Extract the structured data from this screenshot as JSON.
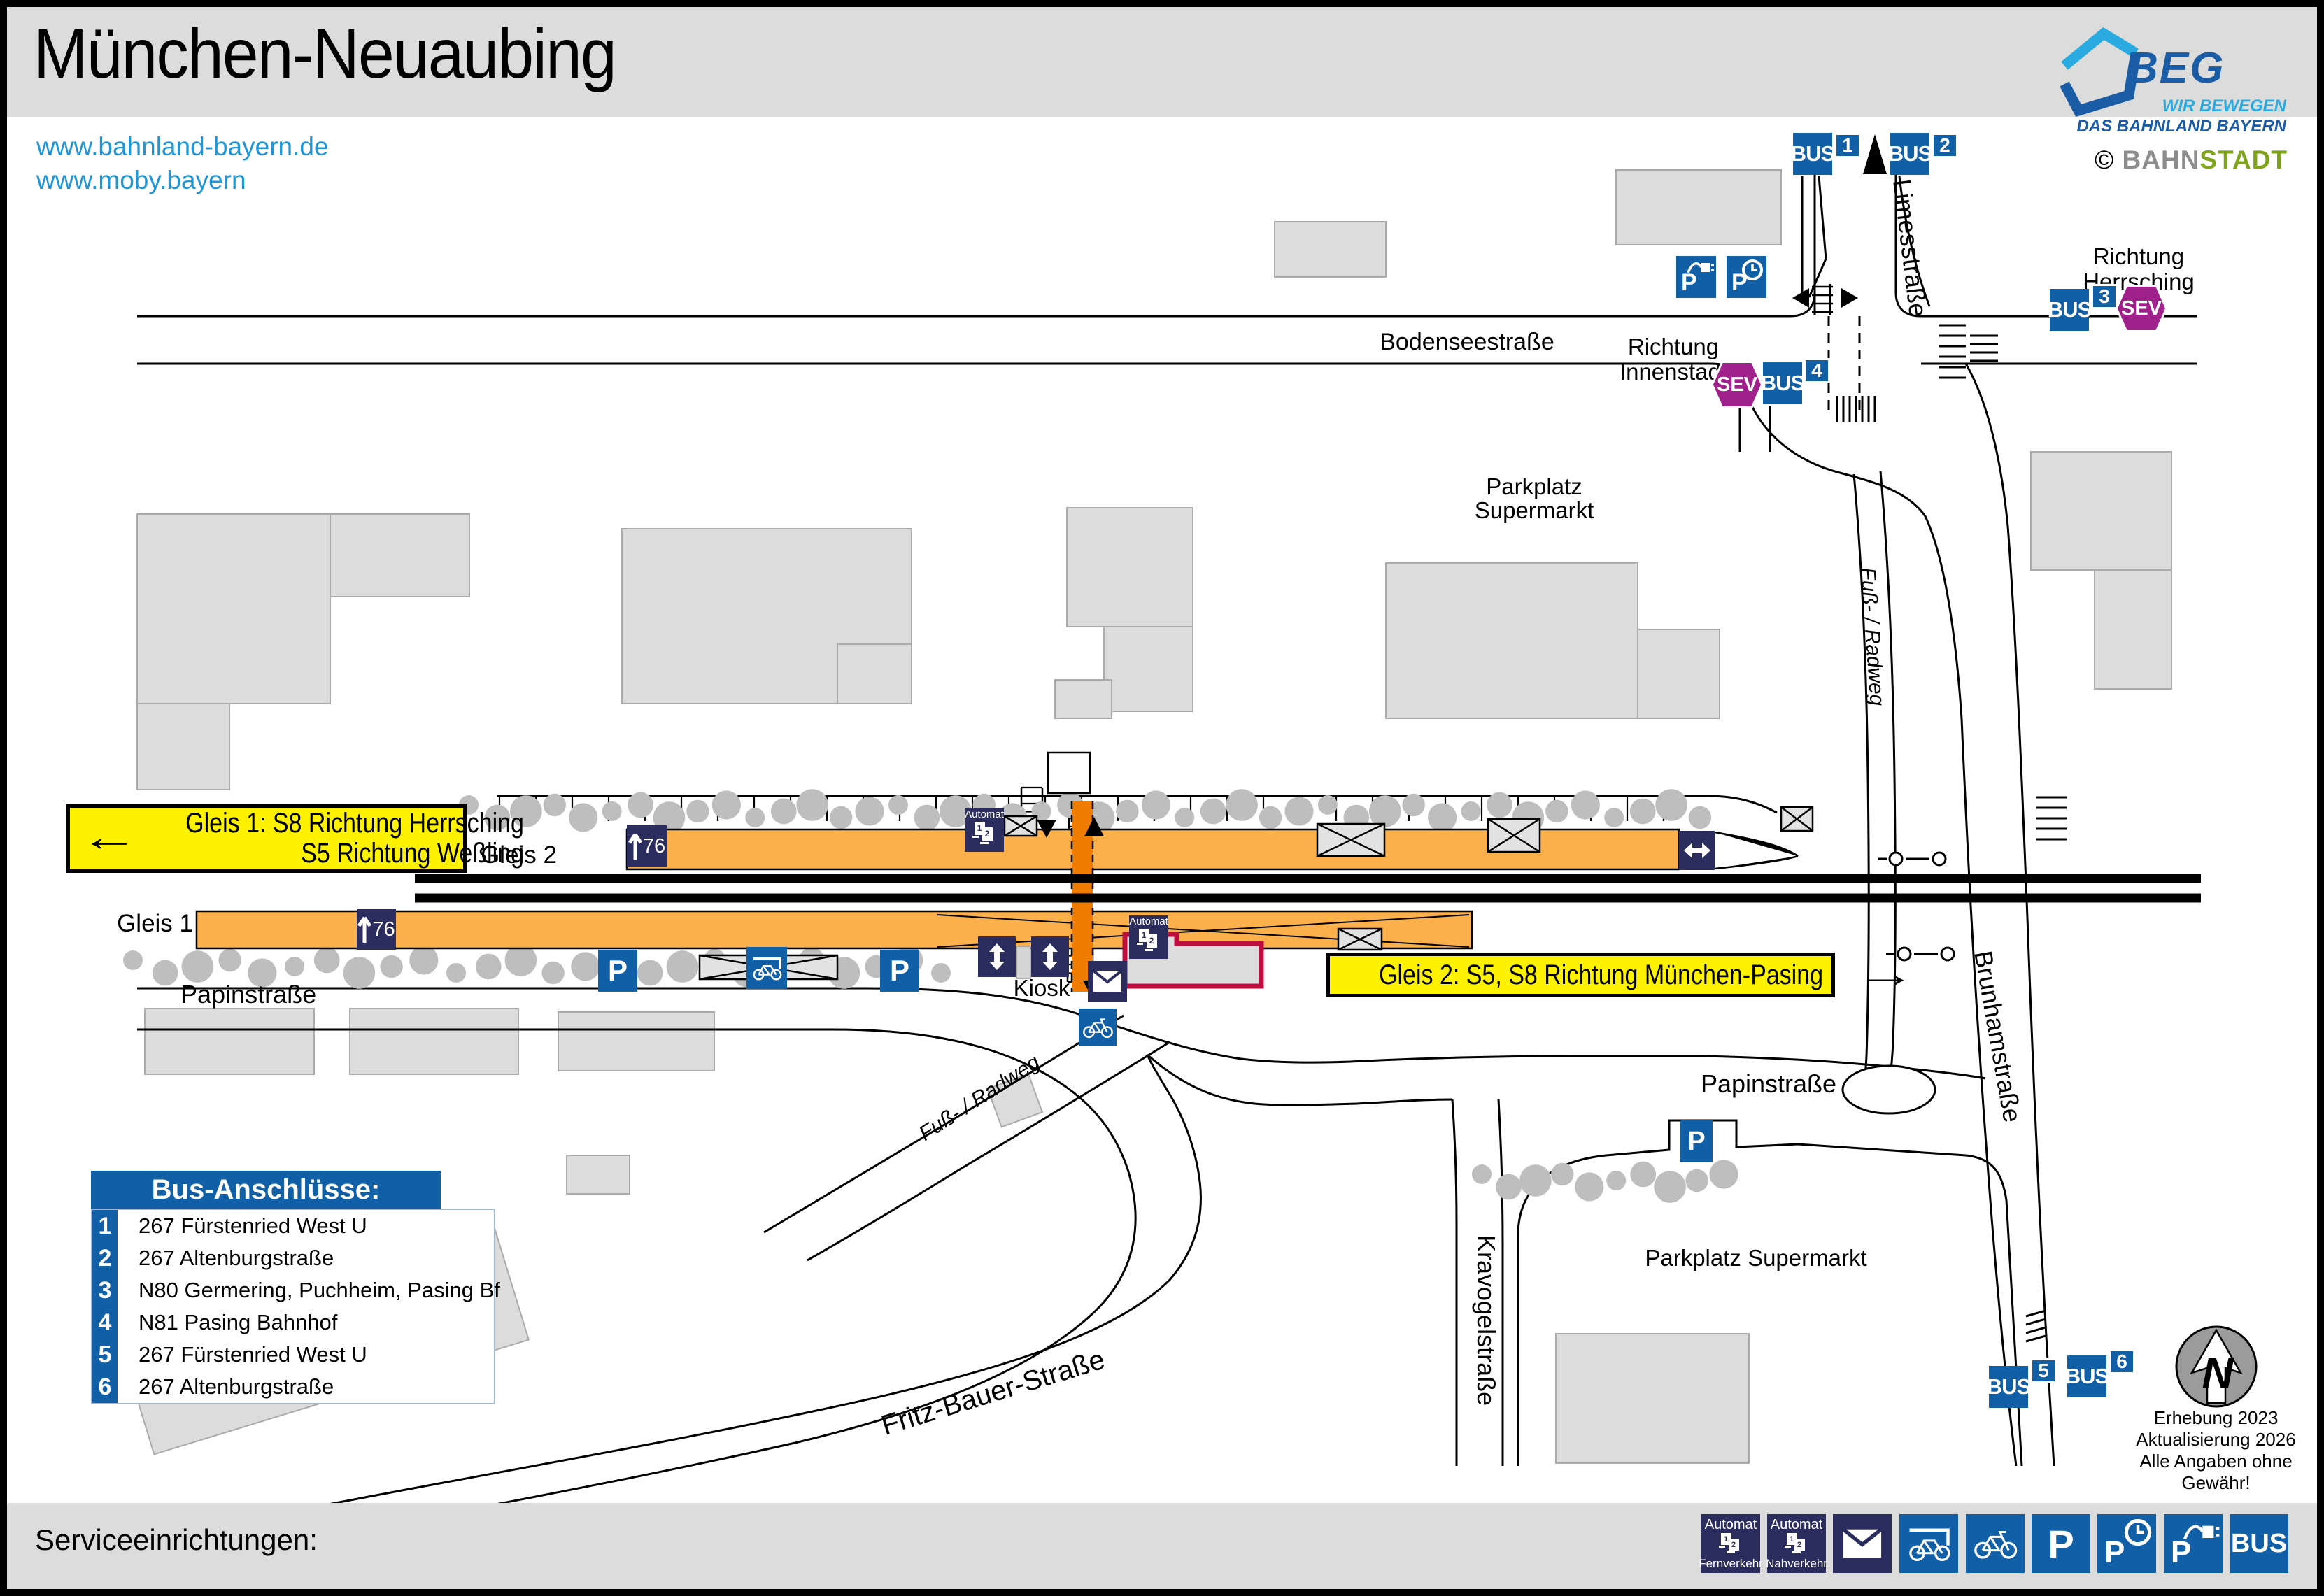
{
  "colors": {
    "blue": "#1160A7",
    "navy": "#2B2D5E",
    "magenta": "#A0208C",
    "platform": "#FBB04B",
    "underpass": "#F07D00",
    "yellow": "#FFF200",
    "red": "#C00D3F",
    "link": "#2196D6",
    "beg_dark": "#1A5DA6",
    "beg_light": "#29ABE2",
    "green": "#7FA41C",
    "gray_band": "#DCDCDC",
    "building": "#DCDCDC",
    "building_border": "#ABABAB",
    "tree": "#BEBEBE"
  },
  "header": {
    "title": "München-Neuaubing",
    "link1": "www.bahnland-bayern.de",
    "link2": "www.moby.bayern"
  },
  "branding": {
    "beg": "BEG",
    "tagline1": "WIR BEWEGEN",
    "tagline2": "DAS BAHNLAND BAYERN",
    "copyright": "©",
    "bahn": "BAHN",
    "stadt": "STADT"
  },
  "signs": {
    "gleis1_arrow": "←",
    "gleis1_line1": "Gleis 1: S8 Richtung Herrsching",
    "gleis1_line2": "S5 Richtung Weßling",
    "gleis2_text": "Gleis 2: S5, S8 Richtung München-Pasing",
    "gleis2_arrow": "→"
  },
  "streets": {
    "bodensee": "Bodenseestraße",
    "limes": "Limesstraße",
    "papin_left": "Papinstraße",
    "papin_right": "Papinstraße",
    "kravogel": "Kravogelstraße",
    "brunham": "Brunhamstraße",
    "fritz": "Fritz-Bauer-Straße",
    "fussweg1": "Fuß- / Radweg",
    "fussweg2": "Fuß- / Radweg"
  },
  "labels": {
    "gleis1": "Gleis 1",
    "gleis2": "Gleis 2",
    "kiosk": "Kiosk",
    "parkplatz_line1": "Parkplatz",
    "parkplatz_line2": "Supermarkt",
    "parkplatz_sued": "Parkplatz Supermarkt",
    "richtung": "Richtung",
    "herrsching": "Herrsching",
    "innenstadt": "Innenstadt",
    "north": "N"
  },
  "badges": {
    "bus": "BUS",
    "sev": "SEV",
    "p": "P",
    "automat": "Automat",
    "height": "76",
    "d1": "1",
    "d2": "2",
    "numbers": [
      "1",
      "2",
      "3",
      "4",
      "5",
      "6"
    ]
  },
  "legend": {
    "title": "Bus-Anschlüsse:",
    "items": [
      {
        "num": "1",
        "label": "267 Fürstenried West U"
      },
      {
        "num": "2",
        "label": "267 Altenburgstraße"
      },
      {
        "num": "3",
        "label": "N80 Germering, Puchheim, Pasing Bf"
      },
      {
        "num": "4",
        "label": "N81 Pasing Bahnhof"
      },
      {
        "num": "5",
        "label": "267 Fürstenried West U"
      },
      {
        "num": "6",
        "label": "267 Altenburgstraße"
      }
    ]
  },
  "notes": {
    "line1": "Erhebung 2023",
    "line2": "Aktualisierung 2026",
    "line3": "Alle Angaben ohne Gewähr!"
  },
  "footer": {
    "label": "Serviceeinrichtungen:",
    "fernverkehr": "Fernverkehr",
    "nahverkehr": "Nahverkehr",
    "icons": [
      "ticket-machine-longdistance-icon",
      "ticket-machine-local-icon",
      "mailbox-icon",
      "covered-bike-parking-icon",
      "bike-parking-icon",
      "parking-icon",
      "short-term-parking-icon",
      "ev-charging-parking-icon",
      "bus-stop-icon"
    ]
  }
}
